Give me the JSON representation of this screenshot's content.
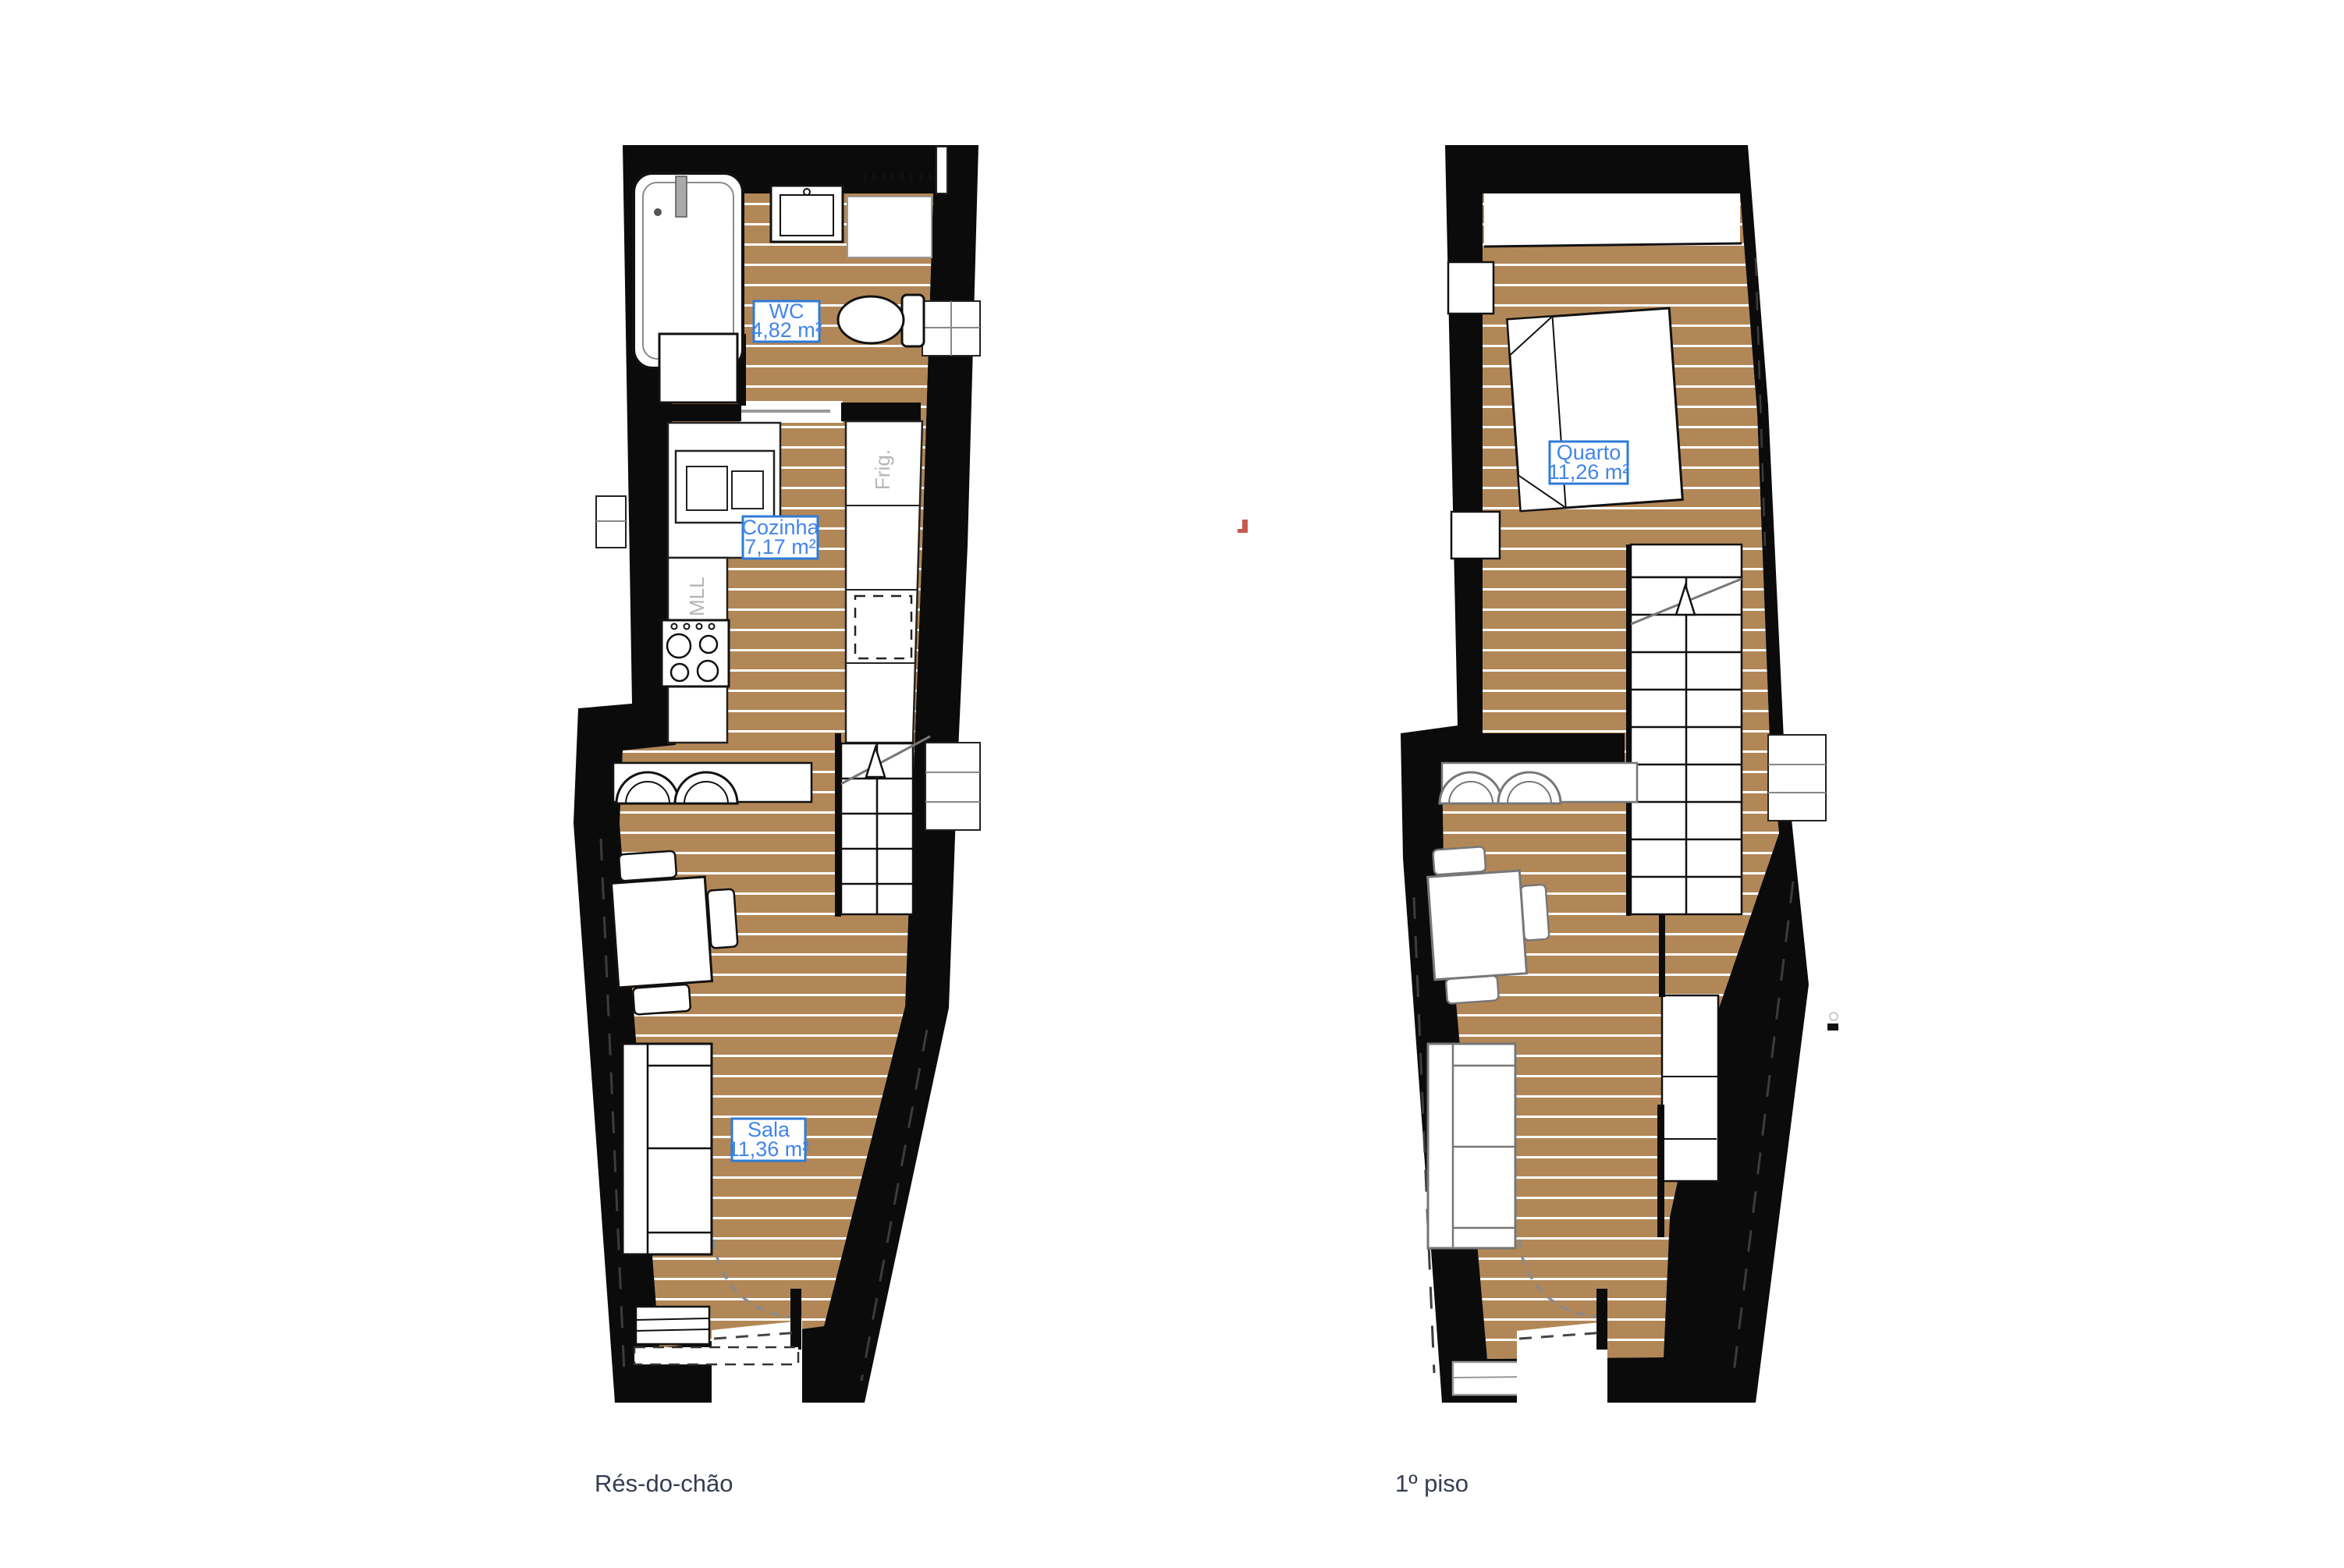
{
  "document": {
    "type": "architectural-floor-plan-sheet",
    "background_color": "#ffffff"
  },
  "colors": {
    "wall": "#0b0b0b",
    "wood_floor": "#b28757",
    "plank_line": "#ffffff",
    "room_label_text": "#4285e8",
    "room_label_border": "#2e7bd6",
    "appliance_text": "#b5b5b5",
    "floor_label_text": "#363c52",
    "door_arc": "#8a8a8a",
    "accent_mark": "#c65b4e"
  },
  "plans": [
    {
      "name_label": "Rés-do-chão",
      "rooms": [
        {
          "name": "WC",
          "area": "4,82 m²"
        },
        {
          "name": "Cozinha",
          "area": "7,17 m²"
        },
        {
          "name": "Sala",
          "area": "11,36 m²"
        }
      ],
      "appliance_labels": {
        "dishwasher": "MLL",
        "fridge": "Frig."
      }
    },
    {
      "name_label": "1º piso",
      "rooms": [
        {
          "name": "Quarto",
          "area": "11,26 m²"
        }
      ]
    }
  ]
}
